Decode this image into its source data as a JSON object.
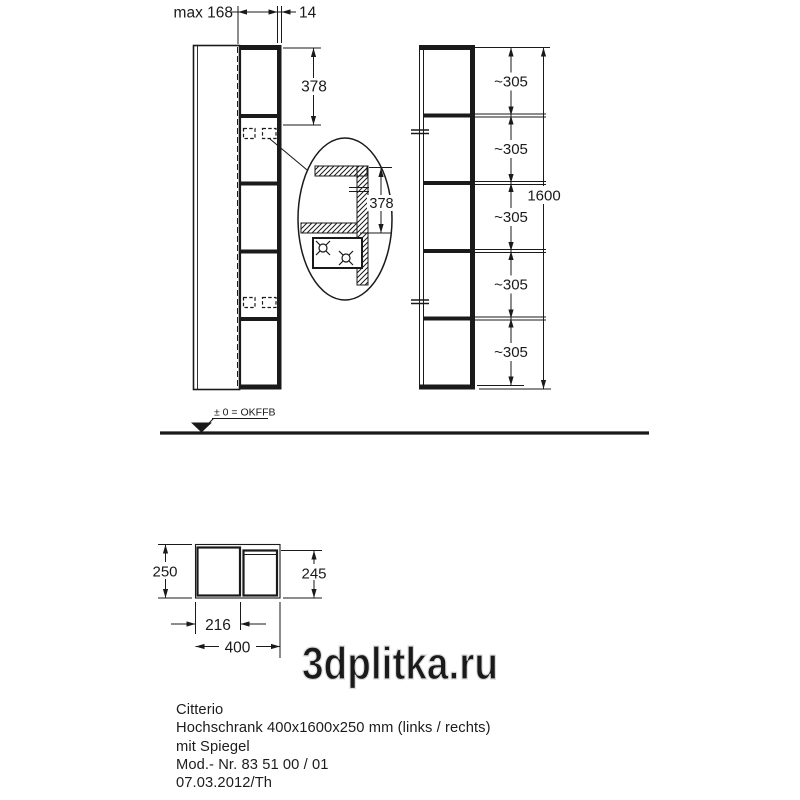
{
  "product": {
    "series": "Citterio",
    "description": "Hochschrank 400x1600x250 mm (links / rechts)",
    "feature": "mit Spiegel",
    "model_no": "Mod.- Nr. 83 51 00 / 01",
    "date_ref": "07.03.2012/Th"
  },
  "dims": {
    "max_width": "max 168",
    "panel_thickness": "14",
    "top_offset": "378",
    "detail_offset": "378",
    "spacing": [
      "~305",
      "~305",
      "~305",
      "~305",
      "~305"
    ],
    "total_height": "1600",
    "depth_left": "250",
    "depth_right": "245",
    "door_width": "216",
    "total_width": "400"
  },
  "floor_label": "± 0 = OKFFB",
  "watermark": "3dplitka.ru",
  "colors": {
    "line": "#1a1a1a",
    "watermark_outline": "#dcdcdc",
    "background": "#ffffff"
  }
}
